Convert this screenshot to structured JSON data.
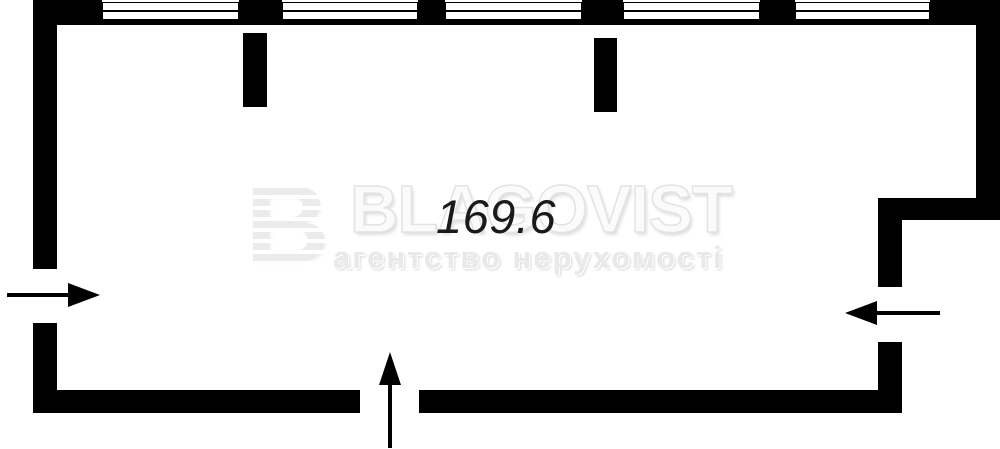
{
  "plan": {
    "area_label": "169.6",
    "colors": {
      "wall": "#000000",
      "background": "#ffffff",
      "area_text": "#1a1a1a",
      "watermark_light": "#ebebeb"
    },
    "walls": [
      {
        "name": "left-wall-upper",
        "x": 33,
        "y": 0,
        "w": 24,
        "h": 269
      },
      {
        "name": "left-wall-lower",
        "x": 33,
        "y": 323,
        "w": 24,
        "h": 90
      },
      {
        "name": "top-wall-sill-band",
        "x": 33,
        "y": 20,
        "w": 967,
        "h": 5
      },
      {
        "name": "top-wall-pier-1",
        "x": 33,
        "y": 0,
        "w": 69,
        "h": 25
      },
      {
        "name": "top-wall-pier-2",
        "x": 239,
        "y": 0,
        "w": 43,
        "h": 25
      },
      {
        "name": "top-wall-pier-3",
        "x": 418,
        "y": 0,
        "w": 27,
        "h": 25
      },
      {
        "name": "top-wall-pier-4",
        "x": 582,
        "y": 0,
        "w": 41,
        "h": 25
      },
      {
        "name": "top-wall-pier-5",
        "x": 760,
        "y": 0,
        "w": 35,
        "h": 25
      },
      {
        "name": "top-wall-pier-6",
        "x": 930,
        "y": 0,
        "w": 70,
        "h": 25
      },
      {
        "name": "right-wall-upper",
        "x": 976,
        "y": 0,
        "w": 24,
        "h": 220
      },
      {
        "name": "right-step-wall",
        "x": 878,
        "y": 198,
        "w": 122,
        "h": 22
      },
      {
        "name": "right-inner-wall-upper",
        "x": 878,
        "y": 198,
        "w": 24,
        "h": 89
      },
      {
        "name": "right-inner-wall-lower",
        "x": 878,
        "y": 342,
        "w": 24,
        "h": 71
      },
      {
        "name": "bottom-wall-left",
        "x": 33,
        "y": 390,
        "w": 327,
        "h": 23
      },
      {
        "name": "bottom-wall-right",
        "x": 419,
        "y": 390,
        "w": 483,
        "h": 23
      }
    ],
    "stubs": [
      {
        "name": "interior-wall-stub-1",
        "x": 243,
        "y": 33,
        "w": 24,
        "h": 74
      },
      {
        "name": "interior-wall-stub-2",
        "x": 594,
        "y": 38,
        "w": 23,
        "h": 74
      }
    ],
    "windows": [
      {
        "name": "window-1",
        "x": 102,
        "w": 137
      },
      {
        "name": "window-2",
        "x": 282,
        "w": 136
      },
      {
        "name": "window-3",
        "x": 445,
        "w": 137
      },
      {
        "name": "window-4",
        "x": 623,
        "w": 137
      },
      {
        "name": "window-5",
        "x": 795,
        "w": 135
      }
    ],
    "arrows": [
      {
        "name": "entrance-arrow-left",
        "dir": "right",
        "tipX": 100,
        "tipY": 295,
        "tail": 7
      },
      {
        "name": "entrance-arrow-right",
        "dir": "left",
        "tipX": 845,
        "tipY": 313,
        "tail": 940
      },
      {
        "name": "entrance-arrow-bottom",
        "dir": "up",
        "tipX": 390,
        "tipY": 352,
        "tail": 448
      }
    ]
  },
  "watermark": {
    "brand": "BLAGOVIST",
    "tagline": "агентство нерухомості",
    "logo_letter": "B",
    "logo_icon": "blagovist-striped-b-logo"
  }
}
